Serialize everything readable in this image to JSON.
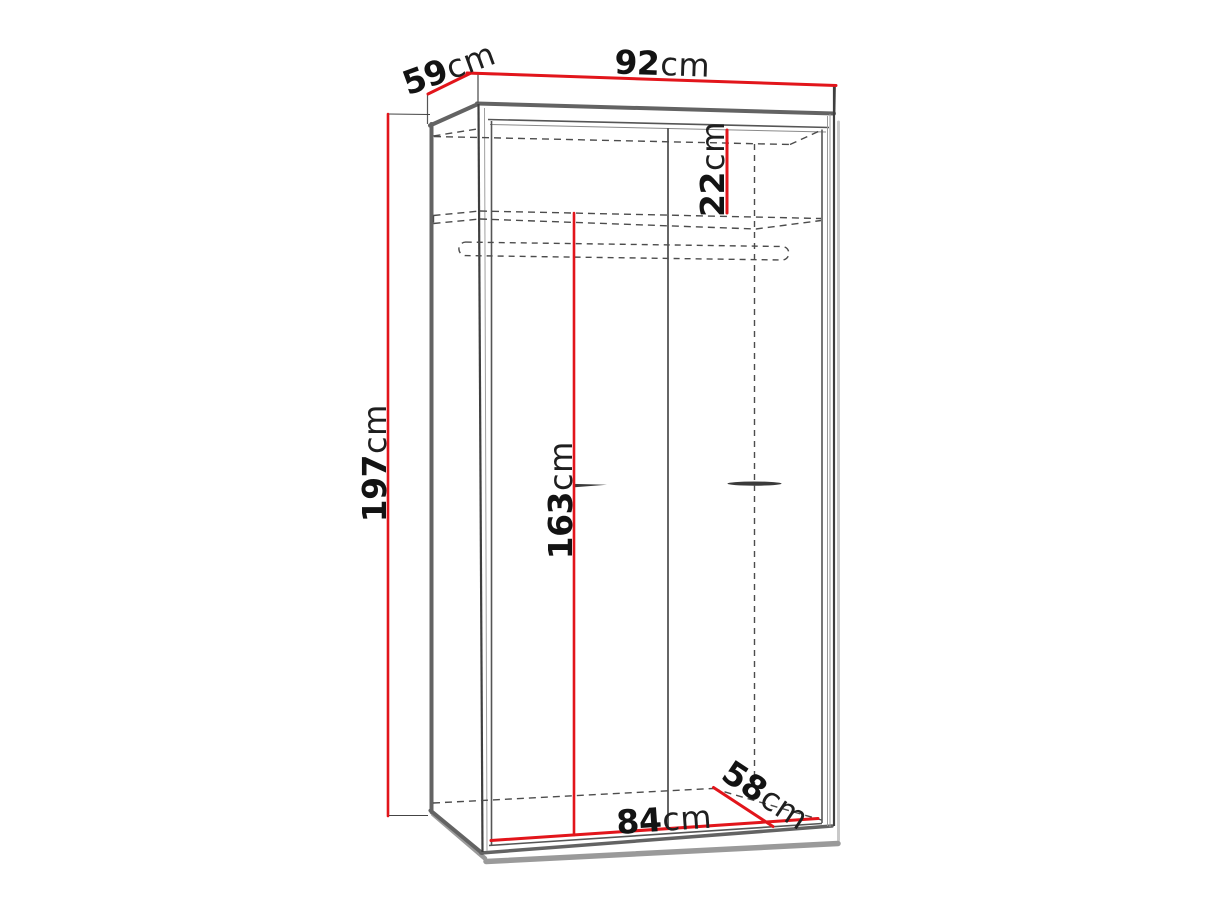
{
  "colors": {
    "dimension": "#e2151b",
    "outline_heavy": "#636363",
    "outline_dark": "#3f3f3f",
    "frame": "#555555",
    "hidden_dashed": "#4c4c4c",
    "shadow": "#9a9a9a",
    "side_shadow": "#c9c9c9",
    "background": "#ffffff"
  },
  "dims": {
    "d92": {
      "value": "92",
      "unit": "cm"
    },
    "d59": {
      "value": "59",
      "unit": "cm"
    },
    "d197": {
      "value": "197",
      "unit": "cm"
    },
    "d22": {
      "value": "22",
      "unit": "cm"
    },
    "d163": {
      "value": "163",
      "unit": "cm"
    },
    "d84": {
      "value": "84",
      "unit": "cm"
    },
    "d58": {
      "value": "58",
      "unit": "cm"
    }
  }
}
